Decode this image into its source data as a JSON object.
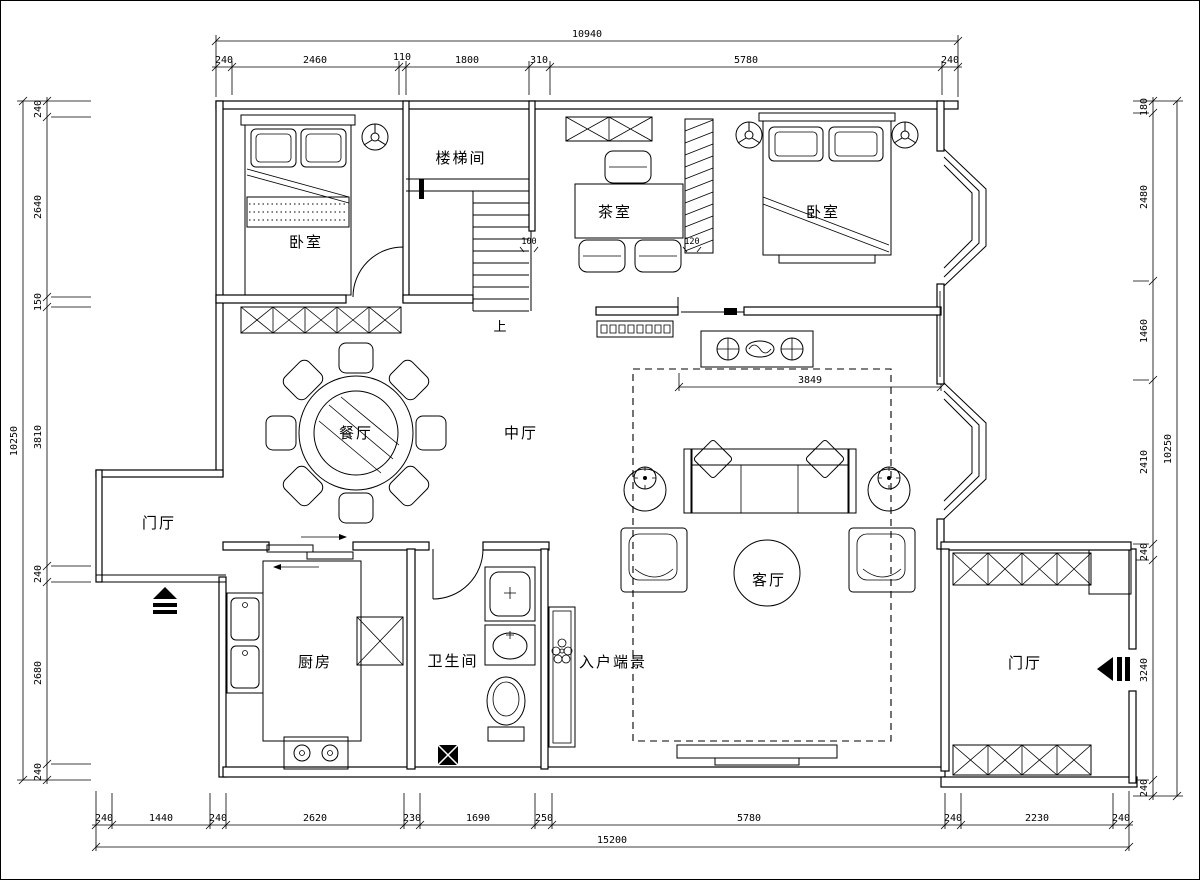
{
  "drawing": {
    "rooms": {
      "bedroom_left": "卧室",
      "bedroom_right": "卧室",
      "stairwell": "楼梯间",
      "tea_room": "茶室",
      "central_hall": "中厅",
      "dining_room": "餐厅",
      "living_room": "客厅",
      "kitchen": "厨房",
      "bathroom": "卫生间",
      "entry_feature": "入户端景",
      "foyer_left": "门厅",
      "foyer_right": "门厅",
      "stair_up_label": "上"
    },
    "dims": {
      "top": {
        "overall": "10940",
        "segments": [
          "240",
          "2460",
          "110",
          "1800",
          "310",
          "5780",
          "240"
        ]
      },
      "bottom": {
        "overall": "15200",
        "segments": [
          "240",
          "1440",
          "240",
          "2620",
          "230",
          "1690",
          "250",
          "5780",
          "240",
          "2230",
          "240"
        ]
      },
      "left": {
        "overall": "10250",
        "segments": [
          "240",
          "2640",
          "150",
          "3810",
          "240",
          "2680",
          "240"
        ]
      },
      "right": {
        "overall": "10250",
        "segments": [
          "180",
          "2480",
          "1460",
          "2410",
          "240",
          "3240",
          "240"
        ]
      },
      "inner": {
        "living_width": "3849",
        "stair_step": "100",
        "screen": "120"
      }
    },
    "colors": {
      "line": "#000000",
      "background": "#ffffff"
    }
  }
}
